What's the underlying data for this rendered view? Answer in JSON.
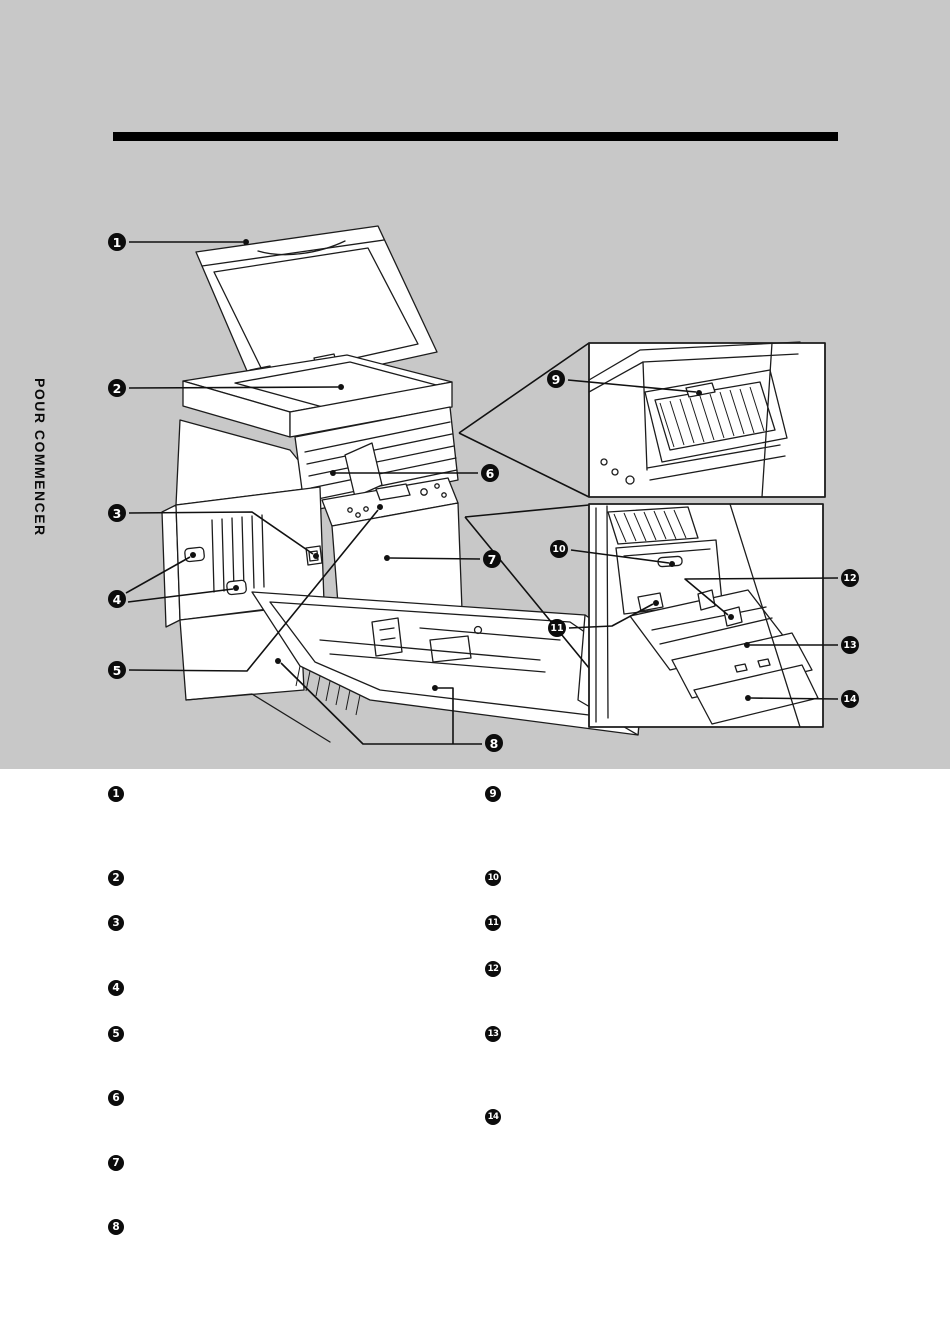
{
  "section_label": "POUR COMMENCER",
  "colors": {
    "band_background": "#c8c8c8",
    "page_background": "#ffffff",
    "rule_color": "#000000",
    "ink": "#1c1c1c"
  },
  "diagram": {
    "callouts": [
      {
        "n": "1",
        "cx": 117,
        "cy": 242
      },
      {
        "n": "2",
        "cx": 117,
        "cy": 388
      },
      {
        "n": "3",
        "cx": 117,
        "cy": 513
      },
      {
        "n": "4",
        "cx": 117,
        "cy": 599
      },
      {
        "n": "5",
        "cx": 117,
        "cy": 670
      },
      {
        "n": "6",
        "cx": 490,
        "cy": 473
      },
      {
        "n": "7",
        "cx": 492,
        "cy": 559
      },
      {
        "n": "8",
        "cx": 494,
        "cy": 743
      },
      {
        "n": "9",
        "cx": 556,
        "cy": 379
      },
      {
        "n": "10",
        "cx": 559,
        "cy": 549
      },
      {
        "n": "11",
        "cx": 557,
        "cy": 628
      },
      {
        "n": "12",
        "cx": 850,
        "cy": 578
      },
      {
        "n": "13",
        "cx": 850,
        "cy": 645
      },
      {
        "n": "14",
        "cx": 850,
        "cy": 699
      }
    ]
  },
  "legend": {
    "left_x": 116,
    "right_x": 493,
    "left_column": [
      {
        "n": "1",
        "y": 794
      },
      {
        "n": "2",
        "y": 878
      },
      {
        "n": "3",
        "y": 923
      },
      {
        "n": "4",
        "y": 988
      },
      {
        "n": "5",
        "y": 1034
      },
      {
        "n": "6",
        "y": 1098
      },
      {
        "n": "7",
        "y": 1163
      },
      {
        "n": "8",
        "y": 1227
      }
    ],
    "right_column": [
      {
        "n": "9",
        "y": 794
      },
      {
        "n": "10",
        "y": 878
      },
      {
        "n": "11",
        "y": 923
      },
      {
        "n": "12",
        "y": 969
      },
      {
        "n": "13",
        "y": 1034
      },
      {
        "n": "14",
        "y": 1117
      }
    ]
  }
}
